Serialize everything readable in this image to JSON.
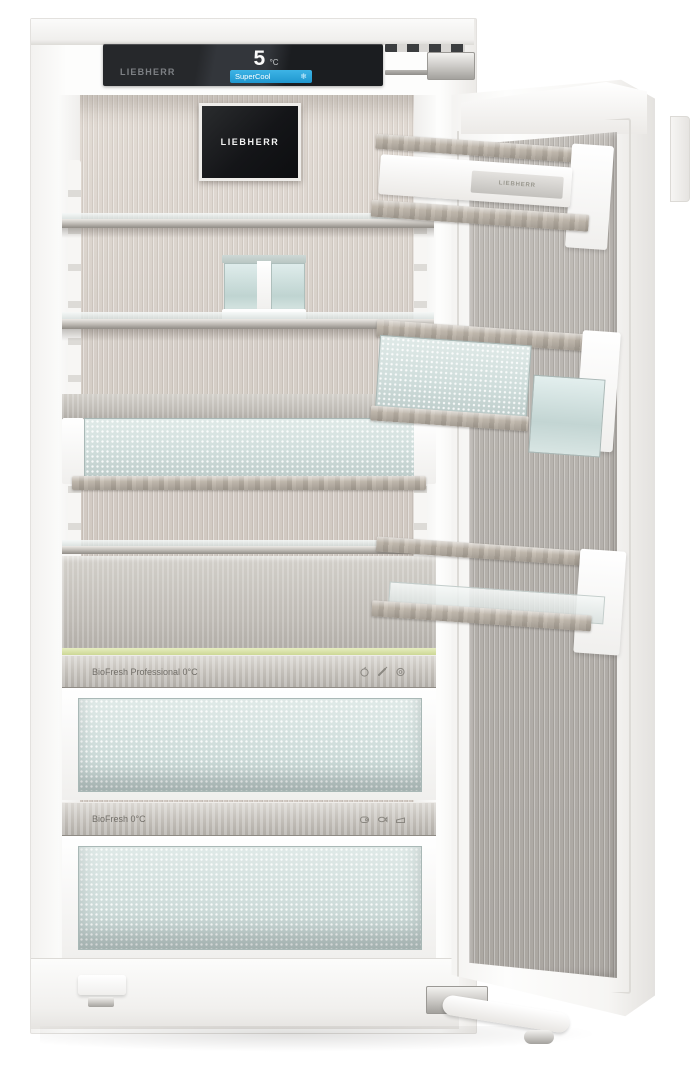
{
  "brand": "LIEBHERR",
  "control_panel": {
    "brand_label": "LIEBHERR",
    "temperature_value": "5",
    "temperature_unit": "°C",
    "supercool_label": "SuperCool",
    "supercool_icon": "snowflake-icon",
    "snowflake_glyph": "❄"
  },
  "inner_display": {
    "brand_label": "LIEBHERR"
  },
  "door": {
    "butter_dish_label": "LIEBHERR"
  },
  "biofresh": {
    "professional": {
      "label": "BioFresh Professional 0°C",
      "icons": [
        "apple-icon",
        "carrot-icon",
        "pepper-icon"
      ]
    },
    "standard": {
      "label": "BioFresh 0°C",
      "icons": [
        "meat-icon",
        "fish-icon",
        "cheese-icon"
      ]
    }
  },
  "colors": {
    "supercool_blue": "#2fa8dd",
    "panel_black": "#1c1e22",
    "interior_steel": "#cfc7c0",
    "door_steel": "#b4b0ab",
    "trim_greige": "#b2aa9f",
    "glass_teal": "#d8e6e4",
    "led_green": "#dbe4a8",
    "body_white": "#fbfbfa"
  }
}
